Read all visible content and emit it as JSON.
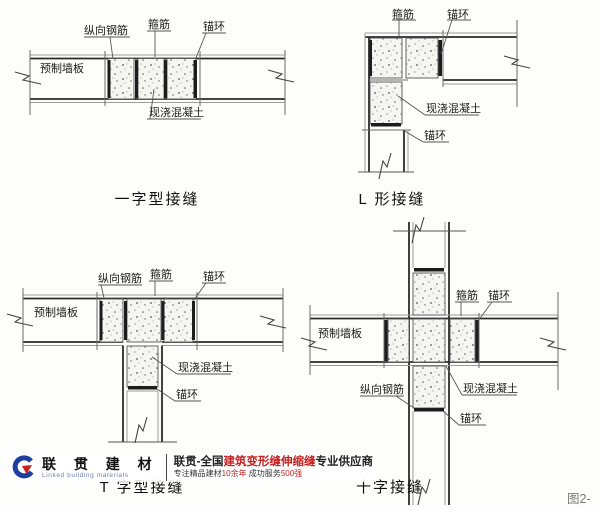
{
  "diagrams": {
    "straight": {
      "caption": "一字型接缝",
      "labels": {
        "longitudinal_rebar": "纵向钢筋",
        "stirrup": "箍筋",
        "anchor_ring": "锚环",
        "precast_panel": "预制墙板",
        "cast_in_place_concrete": "现浇混凝土"
      }
    },
    "l_shape": {
      "caption": "L 形接缝",
      "labels": {
        "stirrup": "箍筋",
        "anchor_ring_top": "锚环",
        "cast_in_place_concrete": "现浇混凝土",
        "anchor_ring_bottom": "锚环"
      }
    },
    "t_shape": {
      "caption": "T 字型接缝",
      "labels": {
        "longitudinal_rebar": "纵向钢筋",
        "stirrup": "箍筋",
        "anchor_ring_top": "锚环",
        "precast_panel": "预制墙板",
        "cast_in_place_concrete": "现浇混凝土",
        "anchor_ring_bottom": "锚环"
      }
    },
    "cross": {
      "caption": "十字接缝",
      "labels": {
        "precast_panel": "预制墙板",
        "stirrup": "箍筋",
        "anchor_ring_right": "锚环",
        "longitudinal_rebar": "纵向钢筋",
        "cast_in_place_concrete": "现浇混凝土",
        "anchor_ring_bottom": "锚环"
      }
    }
  },
  "footer": {
    "brand": {
      "name_cn": "联 贯 建 材",
      "name_en": "Linked building materials"
    },
    "slogan_line1": {
      "prefix": "联贯-全国",
      "highlight": "建筑变形缝伸缩缝",
      "suffix": "专业供应商"
    },
    "slogan_line2": {
      "part1": "专注精品建材",
      "highlight1": "10余年",
      "part2": " 成功服务",
      "highlight2": "500强"
    },
    "figure_label": "图2-"
  },
  "colors": {
    "line": "#2a2a2a",
    "concrete_fill": "#f5f5f1",
    "brand_blue": "#1e3fa0",
    "accent_red": "#c42222",
    "figure_gray": "#7a7a7a"
  }
}
